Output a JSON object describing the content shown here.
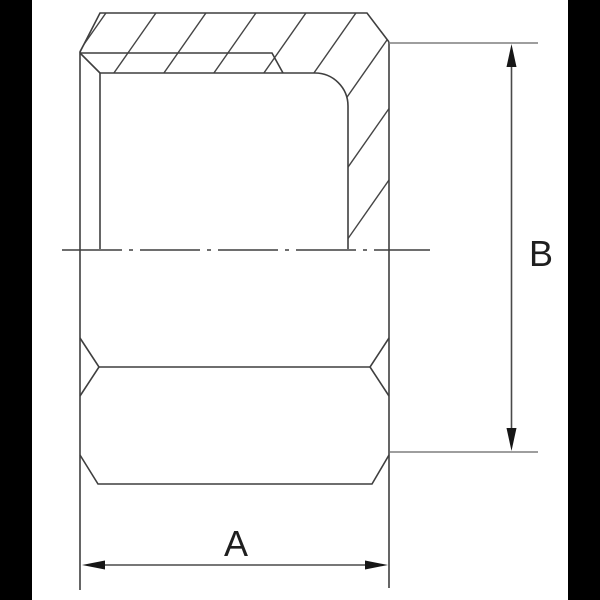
{
  "drawing": {
    "kind": "technical-drawing",
    "subject": "hex cap nut cross-section",
    "dimension_labels": {
      "a": "A",
      "b": "B"
    },
    "colors": {
      "background": "#ffffff",
      "matte": "#000000",
      "outline": "#3f3f3f",
      "hatch": "#454545",
      "centerline": "#3f3f3f",
      "extension_line": "#7f7f7f",
      "dimension_line": "#4a4a4a",
      "arrowhead": "#161616",
      "label": "#1f1f1f"
    }
  }
}
